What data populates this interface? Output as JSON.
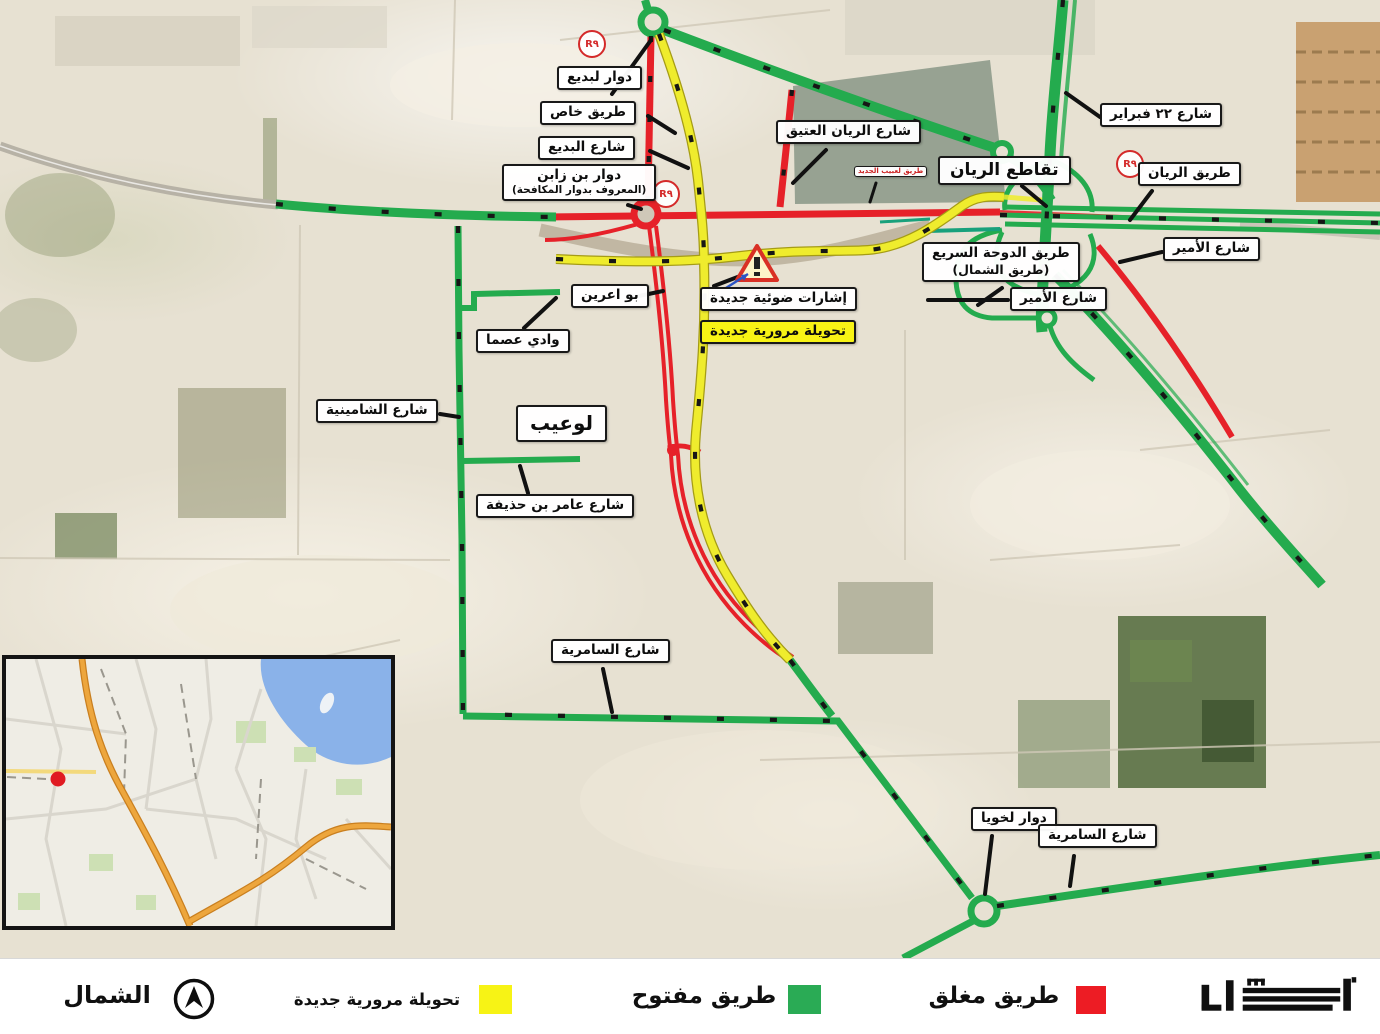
{
  "legend": {
    "north_label": "الشمال",
    "diversion_label": "تحويلة مرورية جديدة",
    "open_label": "طريق مفتوح",
    "closed_label": "طريق مغلق",
    "logo_text": "أشغال",
    "colors": {
      "diversion": "#f7f315",
      "open": "#2aab55",
      "closed": "#ed1c24"
    }
  },
  "map": {
    "road_colors": {
      "open": "#24ab4e",
      "closed": "#e62129",
      "diversion": "#efec2d"
    },
    "badges": {
      "r_badge": "R٩"
    },
    "labels": {
      "lebday_roundabout": "دوار لبديع",
      "private_road": "طريق خاص",
      "al_bidda_street": "شارع البديع",
      "bin_zaben_roundabout": "دوار بن زابن",
      "bin_zaben_roundabout_sub": "(المعروف بدوار المكافحة)",
      "old_rayyan_street": "شارع الريان العتيق",
      "rayyan_intersection": "تقاطع الريان",
      "feb22_street": "شارع ٢٢ فبراير",
      "rayyan_road": "طريق الريان",
      "amir_street_east": "شارع الأمير",
      "doha_expressway": "طريق الدوحة السريع",
      "doha_expressway_sub": "(طريق الشمال)",
      "amir_street_south": "شارع الأمير",
      "bu_aarin": "بو اعرين",
      "wadi_asma": "وادي عصما",
      "shamineya_street": "شارع الشامينية",
      "luaib_district": "لوعيب",
      "amer_bin_huthaifa_street": "شارع عامر بن حذيفة",
      "samriya_street_west": "شارع السامرية",
      "lekhwiya_roundabout": "دوار لخويا",
      "samriya_street_east": "شارع السامرية",
      "new_signals": "إشارات ضوئية جديدة",
      "new_diversion": "تحويلة مرورية جديدة",
      "small_road_label": "طريق لعبيب الجديد"
    }
  }
}
